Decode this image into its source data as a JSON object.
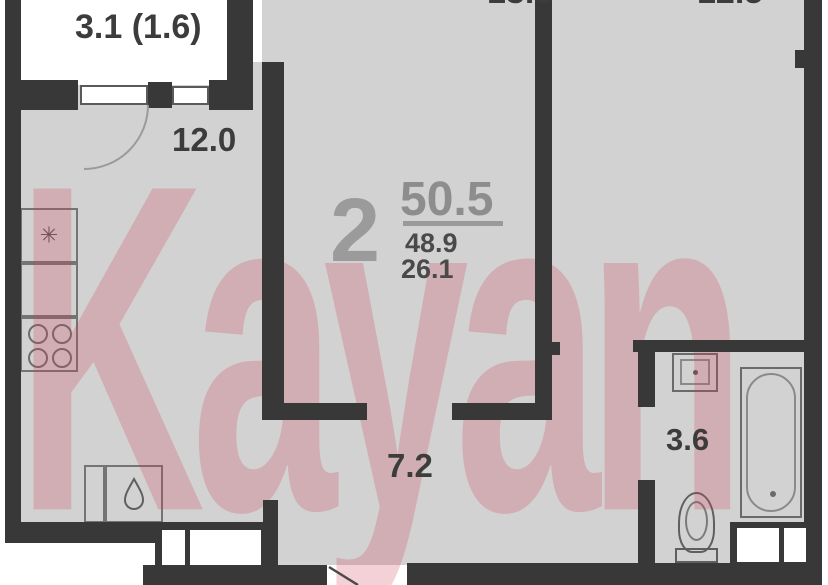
{
  "plan_title": "2-room apartment floor plan",
  "watermark": {
    "text": "Kayan",
    "color_hex": "#cb3e54"
  },
  "summary": {
    "rooms_count": "2",
    "area_total": "50.5",
    "area_secondary": "48.9",
    "area_living": "26.1"
  },
  "rooms": {
    "balcony": {
      "label": "3.1 (1.6)"
    },
    "kitchen": {
      "label": "12.0"
    },
    "room_center": {
      "label": "13.6"
    },
    "room_right": {
      "label": "12.5"
    },
    "hallway": {
      "label": "7.2"
    },
    "bathroom": {
      "label": "3.6"
    }
  },
  "icons": {
    "kitchen_sink": "star-drain-icon",
    "stove": "four-burner-stove-icon",
    "lower_sink": "water-drop-icon",
    "basin": "wash-basin-icon",
    "bathtub": "bathtub-icon",
    "toilet": "toilet-icon"
  },
  "colors": {
    "wall": "#383838",
    "floor": "#d3d2d2",
    "balcony_floor": "#ffffff",
    "area_accent": "#8d8d8d",
    "label_text": "#3c3c3c",
    "watermark_tint": "#f1c9cf"
  }
}
